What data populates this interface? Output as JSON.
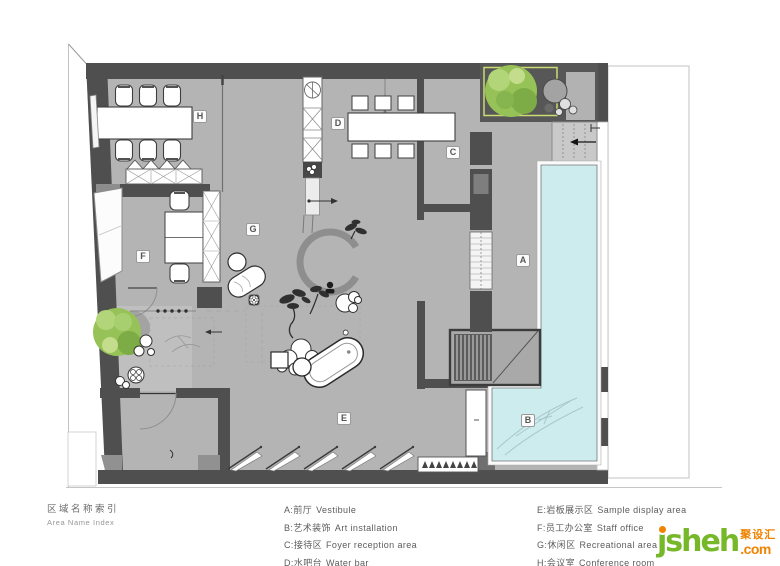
{
  "legend": {
    "index_title_zh": "区域名称索引",
    "index_title_en": "Area Name Index",
    "columns": [
      {
        "items": [
          {
            "key": "A:",
            "zh": "前厅",
            "en": "Vestibule"
          },
          {
            "key": "B:",
            "zh": "艺术装饰",
            "en": "Art installation"
          },
          {
            "key": "C:",
            "zh": "接待区",
            "en": "Foyer reception area"
          },
          {
            "key": "D:",
            "zh": "水吧台",
            "en": "Water bar"
          }
        ]
      },
      {
        "items": [
          {
            "key": "E:",
            "zh": "岩板展示区",
            "en": "Sample display area"
          },
          {
            "key": "F:",
            "zh": "员工办公室",
            "en": "Staff office"
          },
          {
            "key": "G:",
            "zh": "休闲区",
            "en": "Recreational area"
          },
          {
            "key": "H:",
            "zh": "会议室",
            "en": "Conference room"
          }
        ]
      }
    ]
  },
  "plan": {
    "markers": {
      "A": "A",
      "B": "B",
      "C": "C",
      "D": "D",
      "E": "E",
      "F": "F",
      "G": "G",
      "H": "H"
    }
  },
  "logo": {
    "name": "jsheh",
    "cn": "聚设汇",
    "tld": ".com"
  },
  "colors": {
    "wall": "#4f4f4f",
    "floor": "#b4b4b4",
    "pool_water": "#cdecee",
    "tree_green": "#96c258",
    "planter_outline": "#ccdc72",
    "logo_green": "#76b82a",
    "logo_orange": "#f08300"
  }
}
